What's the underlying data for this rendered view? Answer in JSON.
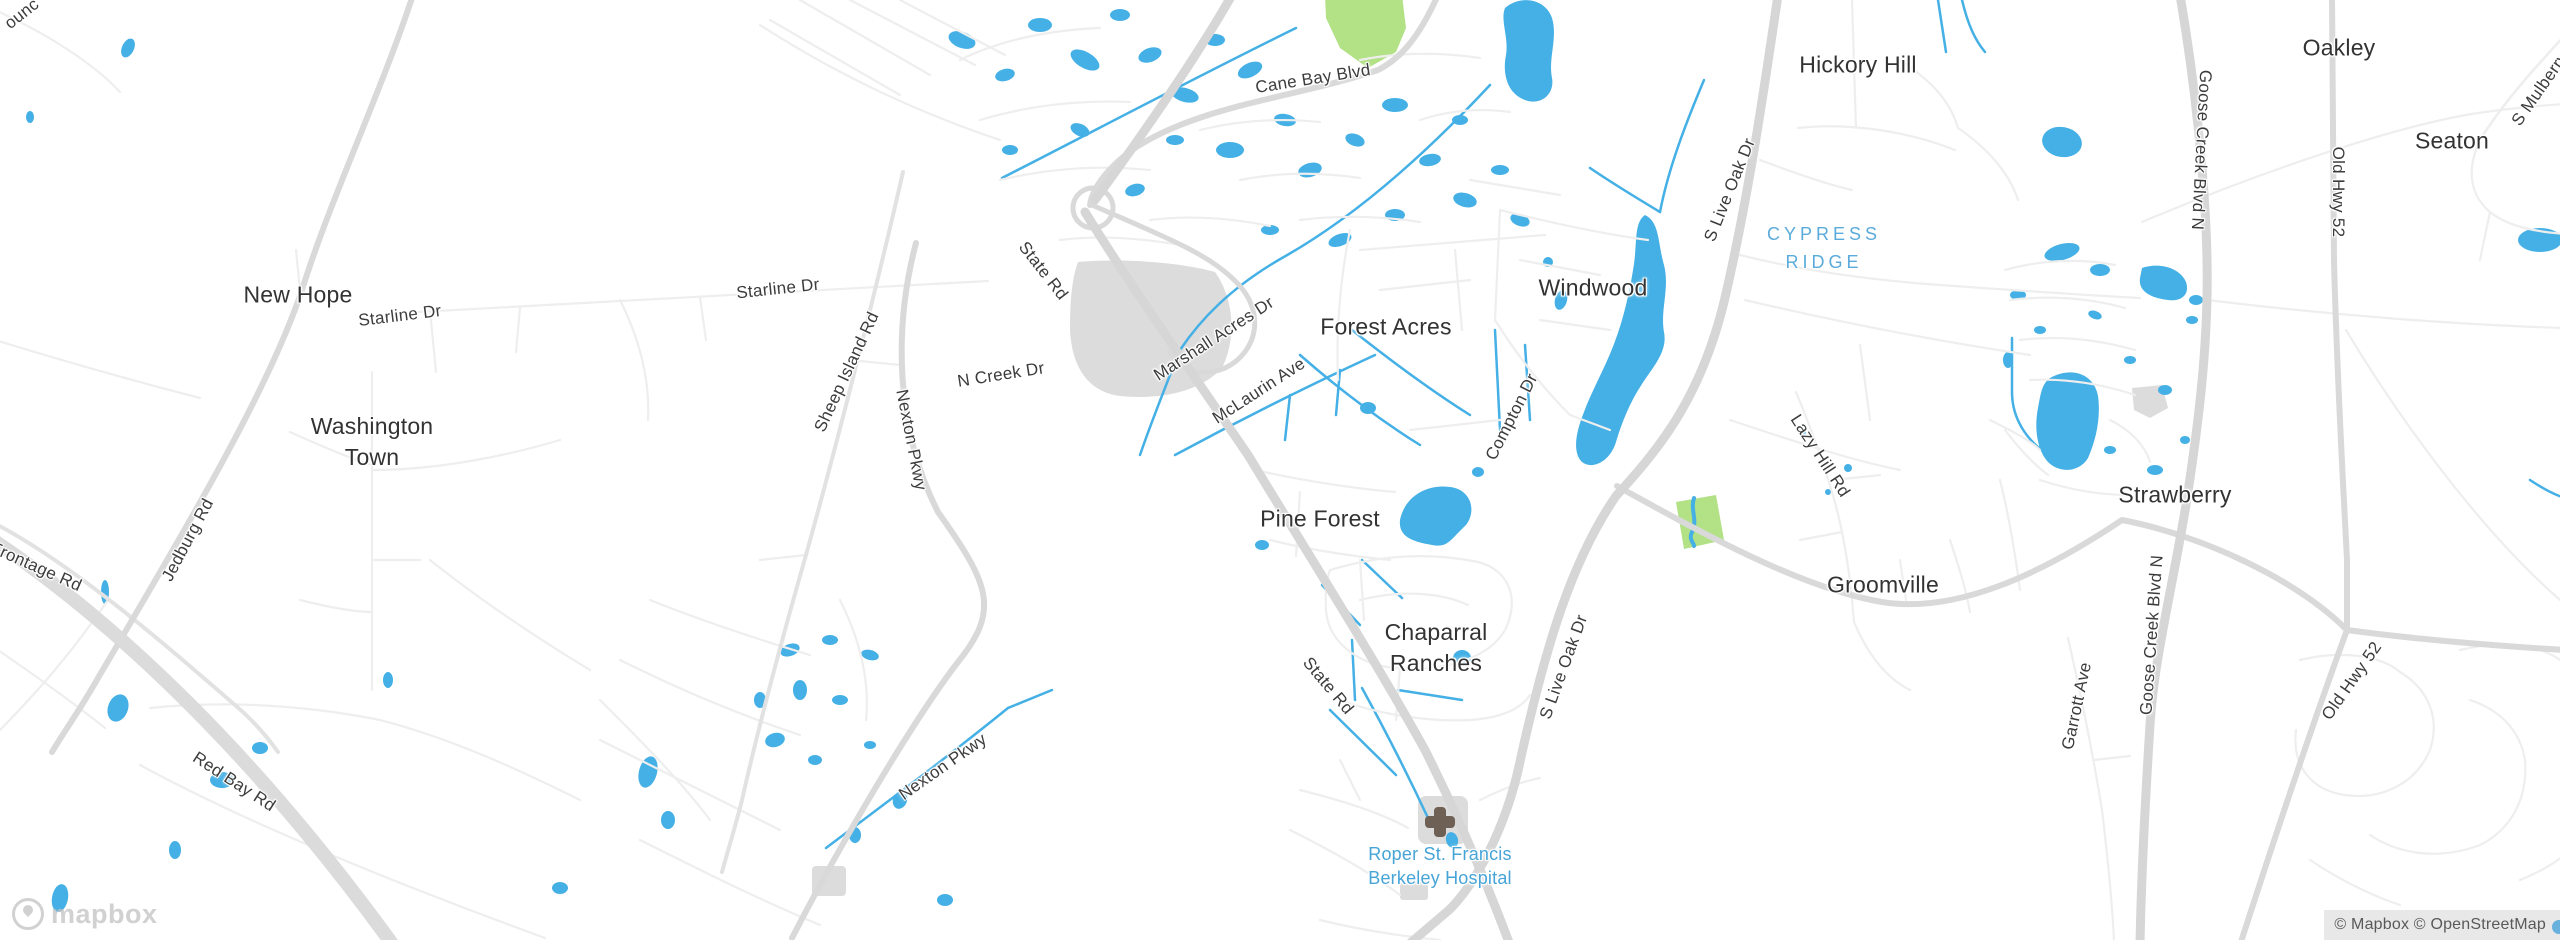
{
  "map": {
    "attribution": "© Mapbox © OpenStreetMap",
    "logo_text": "mapbox",
    "colors": {
      "land": "#ffffff",
      "water": "#44b0e5",
      "park": "#b2e186",
      "built_area": "#dcdcdc",
      "motorway": "#dbdbdb",
      "primary_road": "#d6d6d6",
      "secondary_road": "#d9d9d9",
      "minor_road": "#e2e2e2",
      "street": "#eeeeee",
      "town_label": "#333333",
      "road_label": "#3c3c3c",
      "area_label": "#5aabdb",
      "poi_label": "#46a4d7",
      "hospital_cross": "#6e6054",
      "attribution_text": "#595959"
    },
    "town_labels": [
      {
        "text": "New Hope",
        "x": 298,
        "y": 295
      },
      {
        "lines": [
          "Washington",
          "Town"
        ],
        "x": 372,
        "y": 442
      },
      {
        "text": "Forest Acres",
        "x": 1386,
        "y": 327
      },
      {
        "text": "Windwood",
        "x": 1593,
        "y": 288
      },
      {
        "text": "Pine Forest",
        "x": 1320,
        "y": 519
      },
      {
        "lines": [
          "Chaparral",
          "Ranches"
        ],
        "x": 1436,
        "y": 648
      },
      {
        "text": "Hickory Hill",
        "x": 1858,
        "y": 65
      },
      {
        "text": "Strawberry",
        "x": 2175,
        "y": 495
      },
      {
        "text": "Groomville",
        "x": 1883,
        "y": 585
      },
      {
        "text": "Oakley",
        "x": 2339,
        "y": 48
      },
      {
        "text": "Seaton",
        "x": 2452,
        "y": 141
      }
    ],
    "area_labels": [
      {
        "lines": [
          "CYPRESS",
          "RIDGE"
        ],
        "x": 1824,
        "y": 248
      }
    ],
    "poi_labels": [
      {
        "lines": [
          "Roper St. Francis",
          "Berkeley Hospital"
        ],
        "x": 1440,
        "y": 866,
        "icon": "hospital-cross-icon",
        "icon_x": 1440,
        "icon_y": 822
      }
    ],
    "road_labels": [
      {
        "text": "ounc",
        "x": 22,
        "y": 14,
        "rot": -38
      },
      {
        "text": "Starline Dr",
        "x": 400,
        "y": 316,
        "rot": -7
      },
      {
        "text": "Starline Dr",
        "x": 778,
        "y": 289,
        "rot": -6
      },
      {
        "text": "Sheep Island Rd",
        "x": 847,
        "y": 372,
        "rot": -65
      },
      {
        "text": "Nexton Pkwy",
        "x": 911,
        "y": 440,
        "rot": 79
      },
      {
        "text": "Nexton Pkwy",
        "x": 943,
        "y": 767,
        "rot": -35
      },
      {
        "text": "N Creek Dr",
        "x": 1001,
        "y": 375,
        "rot": -9
      },
      {
        "text": "State Rd",
        "x": 1043,
        "y": 271,
        "rot": 52
      },
      {
        "text": "State Rd",
        "x": 1328,
        "y": 686,
        "rot": 50
      },
      {
        "text": "Marshall Acres Dr",
        "x": 1214,
        "y": 339,
        "rot": -33
      },
      {
        "text": "McLaurin Ave",
        "x": 1259,
        "y": 391,
        "rot": -33
      },
      {
        "text": "Cane Bay Blvd",
        "x": 1313,
        "y": 79,
        "rot": -9
      },
      {
        "text": "Compton Dr",
        "x": 1512,
        "y": 417,
        "rot": -63
      },
      {
        "text": "S Live Oak Dr",
        "x": 1730,
        "y": 190,
        "rot": -68
      },
      {
        "text": "S Live Oak Dr",
        "x": 1564,
        "y": 667,
        "rot": -70
      },
      {
        "text": "Lazy Hill Rd",
        "x": 1820,
        "y": 456,
        "rot": 57
      },
      {
        "text": "Goose Creek Blvd N",
        "x": 2201,
        "y": 150,
        "rot": 93
      },
      {
        "text": "Goose Creek Blvd N",
        "x": 2152,
        "y": 635,
        "rot": -86
      },
      {
        "text": "Old Hwy 52",
        "x": 2338,
        "y": 192,
        "rot": 90
      },
      {
        "text": "Old Hwy 52",
        "x": 2352,
        "y": 681,
        "rot": -55
      },
      {
        "text": "Garrott Ave",
        "x": 2077,
        "y": 706,
        "rot": -78
      },
      {
        "text": "Jedburg Rd",
        "x": 188,
        "y": 540,
        "rot": -62
      },
      {
        "text": "Frontage Rd",
        "x": 36,
        "y": 567,
        "rot": 24
      },
      {
        "text": "Red Bay Rd",
        "x": 234,
        "y": 782,
        "rot": 33
      },
      {
        "text": "S Mulberry Rd",
        "x": 2548,
        "y": 78,
        "rot": -55
      }
    ]
  }
}
